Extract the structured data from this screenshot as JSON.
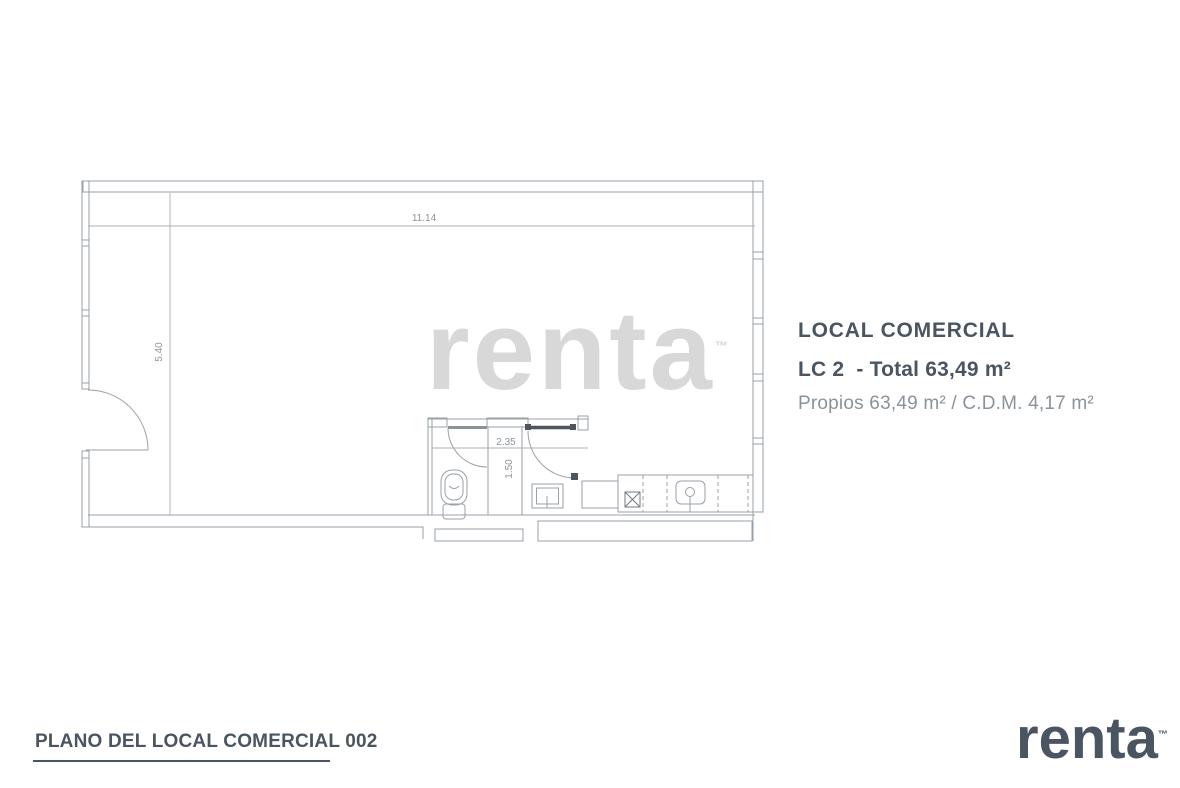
{
  "plan": {
    "dim_width": "11.14",
    "dim_height": "5.40",
    "dim_bath_width": "2.35",
    "dim_bath_height": "1.50",
    "watermark_text": "renta",
    "watermark_tm": "™"
  },
  "info_panel": {
    "title": "LOCAL COMERCIAL",
    "unit_line": "LC 2  - Total 63,49 m²",
    "detail_line": "Propios 63,49 m² / C.D.M. 4,17 m²"
  },
  "footer": {
    "caption": "PLANO DEL LOCAL COMERCIAL 002",
    "logo_text": "renta",
    "logo_tm": "™"
  },
  "colors": {
    "accent": "#4a5561",
    "plan_line": "#99a1a9",
    "dim_line": "#aab0b5",
    "dim_text": "#8d9399",
    "door_leaf_dark": "#4d565e",
    "watermark": "#d8d8d8"
  }
}
